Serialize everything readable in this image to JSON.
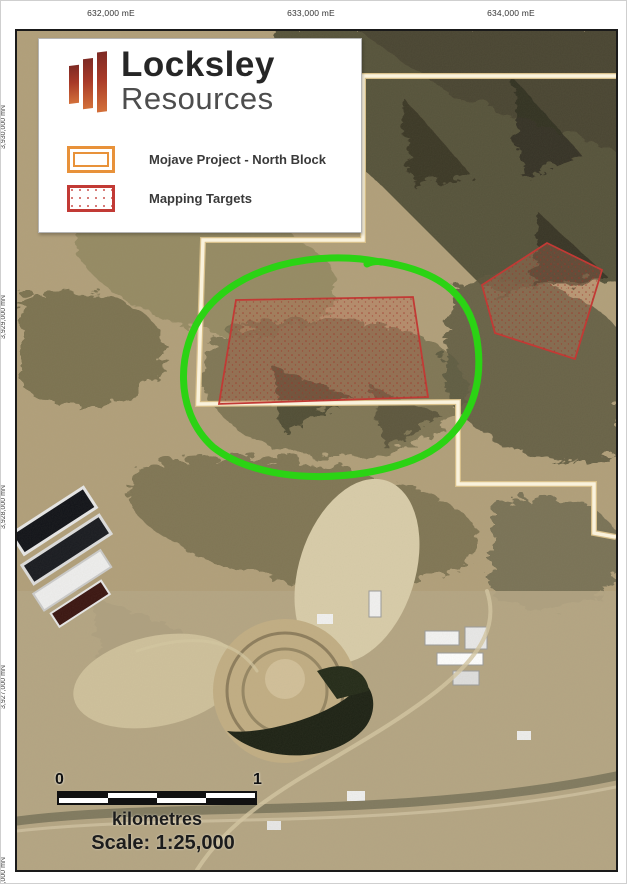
{
  "colors": {
    "annotation_green": "#2bd314",
    "target_red": "#c23a35",
    "project_orange": "#e8923a",
    "boundary_cream": "#f7efd8"
  },
  "top_axis": {
    "labels": [
      "632,000 mE",
      "633,000 mE",
      "634,000 mE"
    ]
  },
  "left_axis": {
    "labels": [
      "3,930,000 mN",
      "3,929,000 mN",
      "3,928,000 mN",
      "3,927,000 mN"
    ],
    "cut_label": "3,926,000 mN"
  },
  "legend": {
    "brand_top": "Locksley",
    "brand_bottom": "Resources",
    "items": [
      {
        "swatch": "orange-double-rectangle",
        "label": "Mojave Project - North Block"
      },
      {
        "swatch": "red-stippled-rectangle",
        "label": "Mapping Targets"
      }
    ]
  },
  "scalebar": {
    "start": "0",
    "end": "1",
    "units": "kilometres",
    "scale_text": "Scale: 1:25,000"
  }
}
